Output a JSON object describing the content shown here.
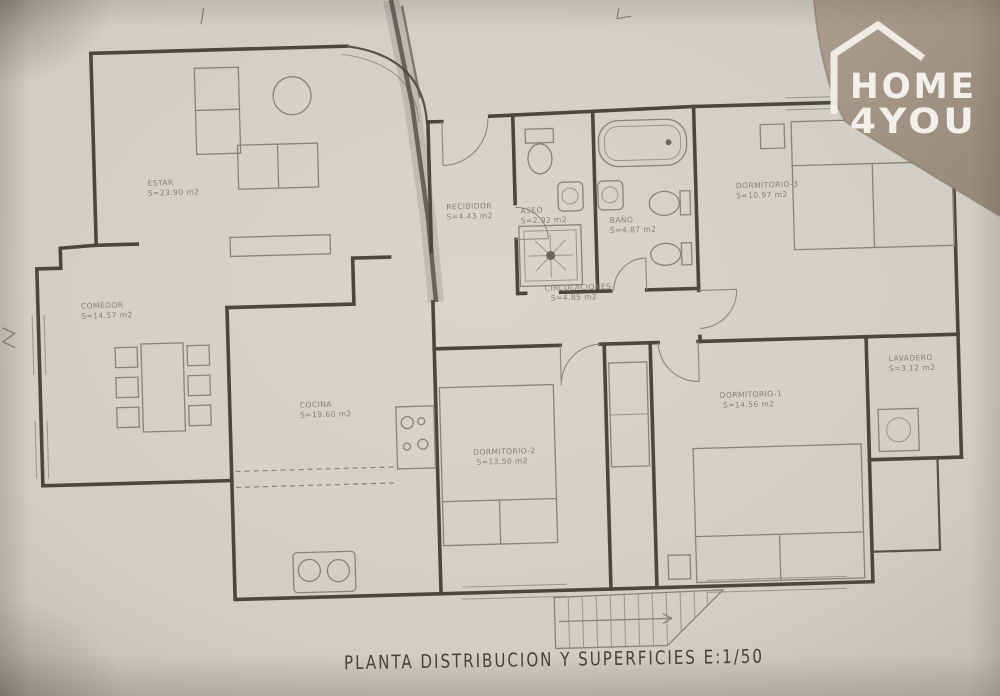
{
  "colors": {
    "paper": "#d3cfca",
    "photo_background": "#a69988",
    "ink": "#4b4740",
    "pencil": "#8a8478",
    "logo": "#f3f0ea"
  },
  "logo": {
    "icon": "house-outline-icon",
    "line1": "HOME",
    "line2": "4YOU"
  },
  "plan": {
    "title": "PLANTA DISTRIBUCION Y SUPERFICIES E:1/50",
    "scale": "E:1/50",
    "compass_mark": "N",
    "rooms": [
      {
        "name": "ESTAR",
        "area": "S=23.90 m2"
      },
      {
        "name": "COMEDOR",
        "area": "S=14.57 m2"
      },
      {
        "name": "COCINA",
        "area": "S=19.60 m2"
      },
      {
        "name": "RECIBIDOR",
        "area": "S=4.43 m2"
      },
      {
        "name": "ASEO",
        "area": "S=2.92 m2"
      },
      {
        "name": "BAÑO",
        "area": "S=4.87 m2"
      },
      {
        "name": "DORMITORIO-3",
        "area": "S=10.97 m2"
      },
      {
        "name": "CIRCULACIONES",
        "area": "S=4.85 m2"
      },
      {
        "name": "DORMITORIO-2",
        "area": "S=13.50 m2"
      },
      {
        "name": "DORMITORIO-1",
        "area": "S=14.56 m2"
      },
      {
        "name": "LAVADERO",
        "area": "S=3.12 m2"
      }
    ]
  }
}
